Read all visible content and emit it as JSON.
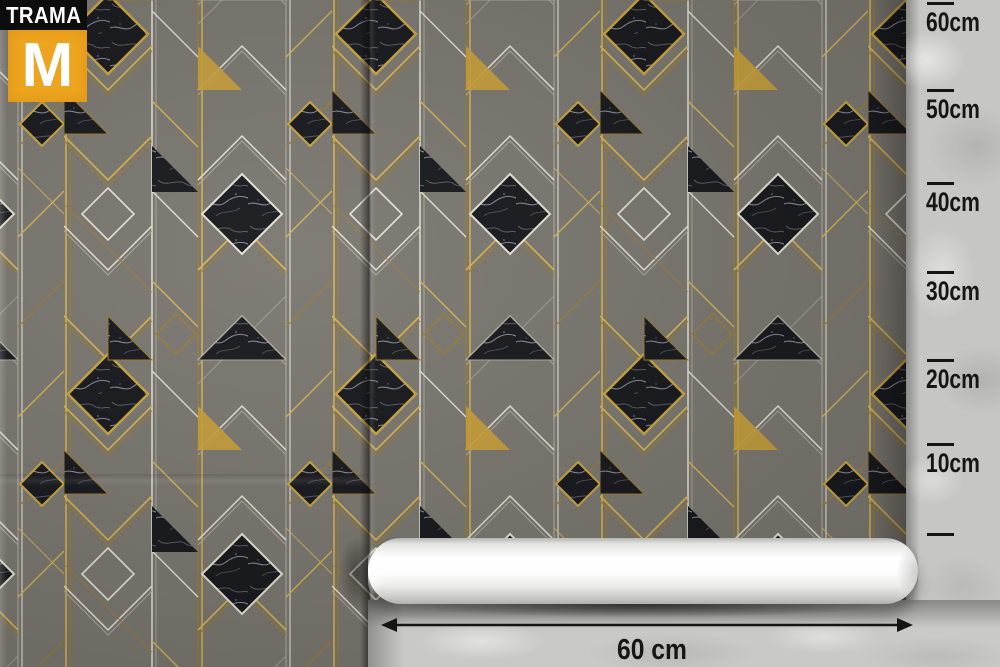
{
  "brand": {
    "name": "TRAMA",
    "initial": "M"
  },
  "ruler": {
    "unit": "cm",
    "side_labels": [
      "60cm",
      "50cm",
      "40cm",
      "30cm",
      "20cm",
      "10cm"
    ],
    "tick_count": 7
  },
  "dimension": {
    "width_label": "60 cm"
  },
  "icons": {
    "dimension_arrow": "double-headed-arrow",
    "ruler_tick": "tick-mark"
  },
  "colors": {
    "logo_orange": "#eda41e",
    "logo_black": "#0d0d0d",
    "wallpaper_gray": "#79756e",
    "gold_line": "#d7b44d",
    "silver_line": "#e6e3d4",
    "marble_black": "#14151a",
    "concrete_gray": "#c6c6c4",
    "ink": "#141414",
    "roll_white": "#ffffff"
  }
}
